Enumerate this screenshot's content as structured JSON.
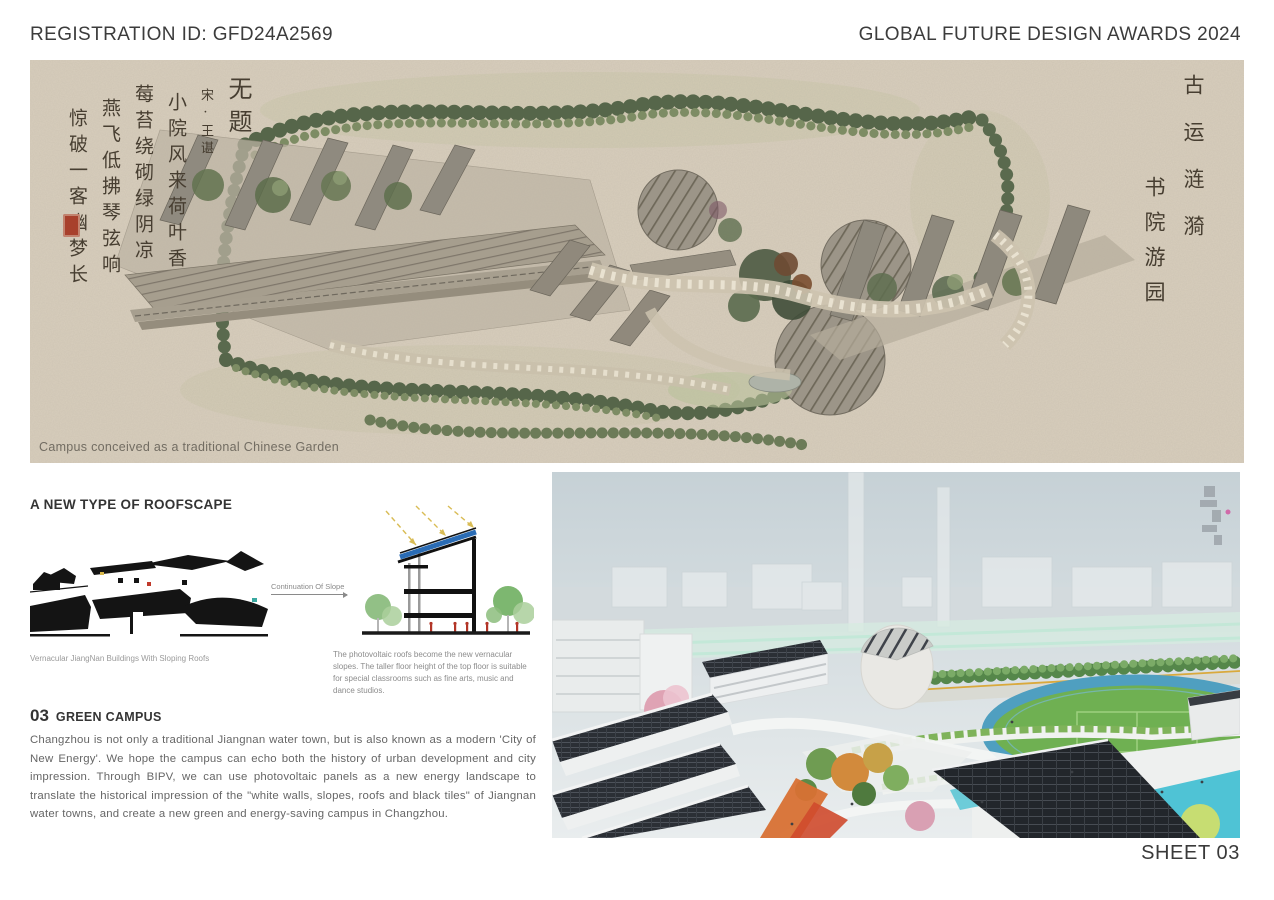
{
  "header": {
    "registration_id": "REGISTRATION ID: GFD24A2569",
    "award_title": "GLOBAL FUTURE DESIGN AWARDS 2024"
  },
  "masterplan": {
    "caption": "Campus conceived as a traditional Chinese Garden",
    "calligraphy_left": {
      "title": "无题",
      "author": "宋·王谌",
      "line1": "小院风来荷叶香",
      "line2": "莓苔绕砌绿阴凉",
      "line3": "燕飞低拂琴弦响",
      "line4": "惊破一客幽梦长"
    },
    "calligraphy_right": {
      "line1": "古运涟漪",
      "line2": "书院游园"
    }
  },
  "roofscape": {
    "heading": "A NEW TYPE OF ROOFSCAPE",
    "arrow_label": "Continuation Of Slope",
    "left_caption": "Vernacular JiangNan Buildings With Sloping Roofs",
    "right_caption": "The photovoltaic roofs become the new vernacular slopes. The taller floor height of the top floor is suitable for special classrooms such as fine arts, music and dance studios."
  },
  "green_campus": {
    "number": "03",
    "heading": "GREEN CAMPUS",
    "body": "Changzhou is not only a traditional Jiangnan water town, but is also known as a modern 'City of New Energy'. We hope the campus can echo both the history of urban development and city impression. Through BIPV, we can use photovoltaic panels as a new energy landscape to translate the historical impression of the \"white walls, slopes, roofs and black tiles\" of Jiangnan water towns, and create a new green and energy-saving campus in Changzhou.",
    "sheet_label": "SHEET 03"
  },
  "colors": {
    "paper": "#d8cebd",
    "ink": "#3a3a3a",
    "pv_panel": "#2b2f35",
    "pv_blue_edge": "#2a6cb5",
    "seal_red": "#a8402c",
    "field_green": "#6fb052",
    "track_blue": "#4f9fc0",
    "pool_cyan": "#4fc3d5"
  }
}
